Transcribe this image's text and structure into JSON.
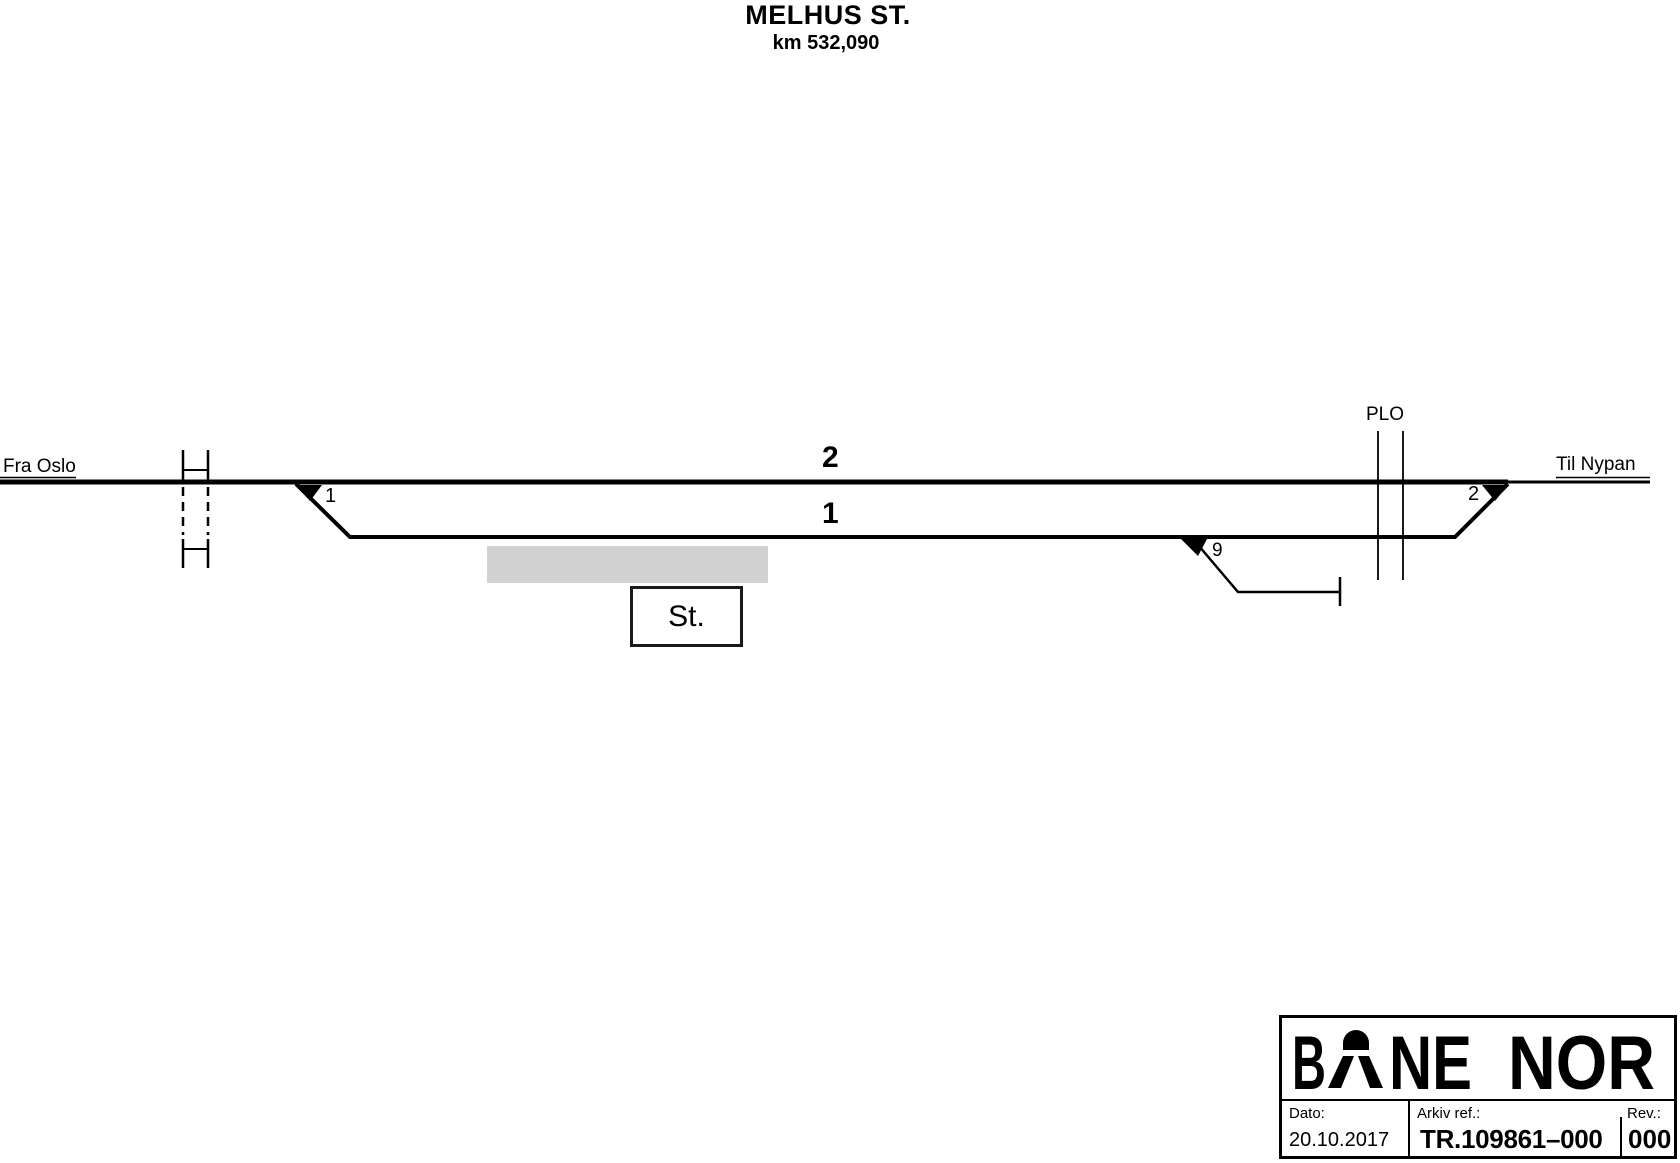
{
  "title": {
    "station": "MELHUS ST.",
    "km": "km 532,090"
  },
  "endpoints": {
    "from": "Fra Oslo",
    "to": "Til Nypan"
  },
  "track_labels": {
    "track2": "2",
    "track1": "1"
  },
  "switch_labels": {
    "sw1": "1",
    "sw2": "2",
    "sw9": "9"
  },
  "level_crossing": {
    "label": "PLO"
  },
  "station_box": {
    "label": "St."
  },
  "logo": {
    "b": "B",
    "ne": "NE",
    "nor": "NOR"
  },
  "title_block": {
    "dato_label": "Dato:",
    "dato_value": "20.10.2017",
    "arkiv_label": "Arkiv ref.:",
    "arkiv_value": "TR.109861–000",
    "rev_label": "Rev.:",
    "rev_value": "000"
  },
  "colors": {
    "ink": "#000000",
    "platform": "#d2d2d2",
    "background": "#ffffff"
  }
}
